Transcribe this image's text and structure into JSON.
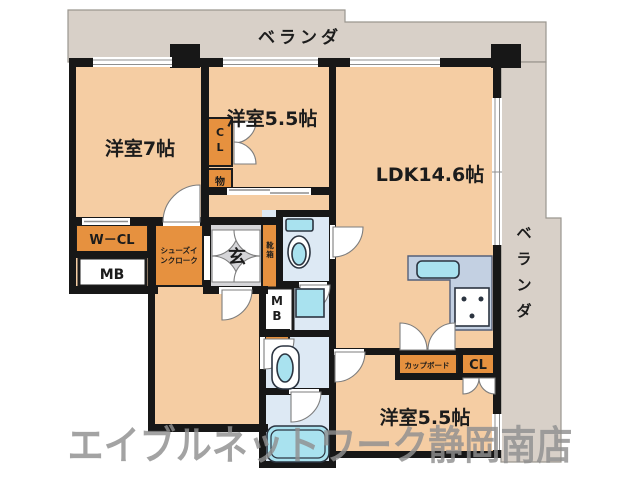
{
  "watermark": "エイブルネットワーク静岡南店",
  "balcony": {
    "top_label": "ベランダ",
    "right_chars": [
      "ベ",
      "ラ",
      "ン",
      "ダ"
    ]
  },
  "rooms": {
    "western7": "洋室7帖",
    "western55_top": "洋室5.5帖",
    "ldk": "LDK14.6帖",
    "western55_bottom": "洋室5.5帖",
    "entrance": "玄"
  },
  "storage": {
    "walk_in_closet": "W－CL",
    "meter_box_left": "MB",
    "meter_box_center_chars": [
      "M",
      "B"
    ],
    "closet_top_chars": [
      "C",
      "L"
    ],
    "storage_small": "物",
    "shoes_cloak_lines": [
      "シューズイ",
      "ンクローク"
    ],
    "shoe_box_chars": [
      "靴",
      "箱"
    ],
    "cupboard": "カップボード",
    "closet_bottom": "CL"
  },
  "colors": {
    "floor": "#f5cda3",
    "closet": "#e6913f",
    "balcony": "#d8d0c8",
    "entrance": "#d5d5d8",
    "water": "#dde9f4",
    "fixture": "#a9e2ef",
    "counter": "#c3d0e2",
    "wall": "#171717",
    "watermark": "#909090"
  }
}
